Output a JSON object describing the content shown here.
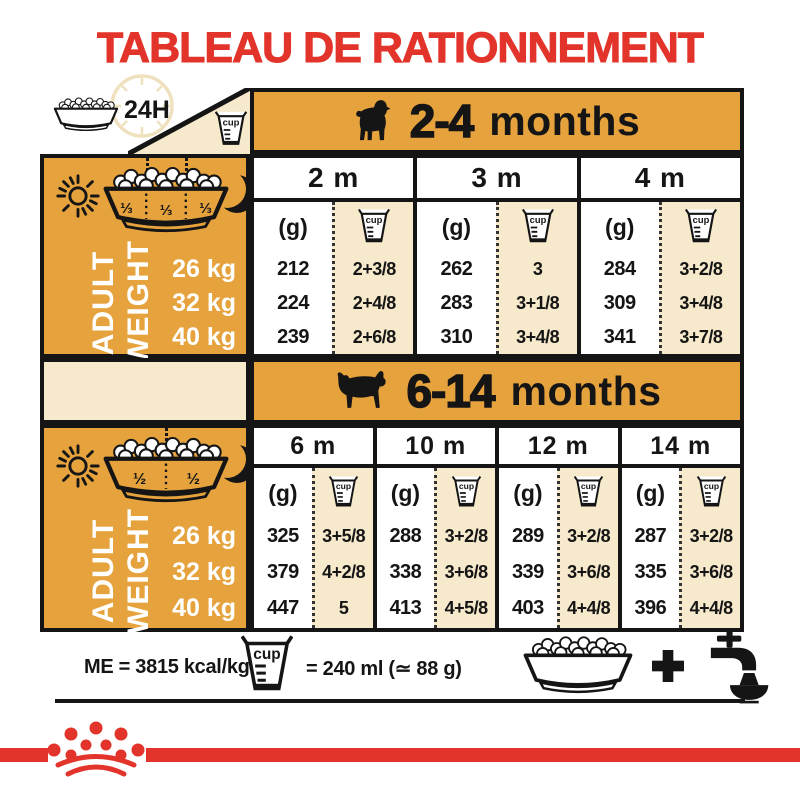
{
  "title": "TABLEAU DE RATIONNEMENT",
  "labels": {
    "daily": "24H",
    "cup": "cup",
    "grams": "(g)",
    "plus": "+"
  },
  "side": {
    "top": "ADULT",
    "bottom": "WEIGHT"
  },
  "bands": [
    {
      "range": "2-4",
      "unit": "months"
    },
    {
      "range": "6-14",
      "unit": "months"
    }
  ],
  "table1": {
    "fractions": [
      "⅓",
      "⅓",
      "⅓"
    ],
    "weights": [
      "26 kg",
      "32 kg",
      "40 kg"
    ],
    "columns": [
      {
        "label": "2 m",
        "grams": [
          "212",
          "224",
          "239"
        ],
        "cups": [
          "2+3/8",
          "2+4/8",
          "2+6/8"
        ]
      },
      {
        "label": "3 m",
        "grams": [
          "262",
          "283",
          "310"
        ],
        "cups": [
          "3",
          "3+1/8",
          "3+4/8"
        ]
      },
      {
        "label": "4 m",
        "grams": [
          "284",
          "309",
          "341"
        ],
        "cups": [
          "3+2/8",
          "3+4/8",
          "3+7/8"
        ]
      }
    ]
  },
  "table2": {
    "fractions": [
      "½",
      "½"
    ],
    "weights": [
      "26 kg",
      "32 kg",
      "40 kg"
    ],
    "columns": [
      {
        "label": "6 m",
        "grams": [
          "325",
          "379",
          "447"
        ],
        "cups": [
          "3+5/8",
          "4+2/8",
          "5"
        ]
      },
      {
        "label": "10 m",
        "grams": [
          "288",
          "338",
          "413"
        ],
        "cups": [
          "3+2/8",
          "3+6/8",
          "4+5/8"
        ]
      },
      {
        "label": "12 m",
        "grams": [
          "289",
          "339",
          "403"
        ],
        "cups": [
          "3+2/8",
          "3+6/8",
          "4+4/8"
        ]
      },
      {
        "label": "14 m",
        "grams": [
          "287",
          "335",
          "396"
        ],
        "cups": [
          "3+2/8",
          "3+6/8",
          "4+4/8"
        ]
      }
    ]
  },
  "footer": {
    "me": "ME = 3815 kcal/kg",
    "cup_equiv": "= 240 ml (≃ 88 g)",
    "plus": "+"
  },
  "colors": {
    "gold": "#E6A33D",
    "cream": "#F7EACC",
    "red": "#E2342A",
    "ink": "#151515"
  }
}
